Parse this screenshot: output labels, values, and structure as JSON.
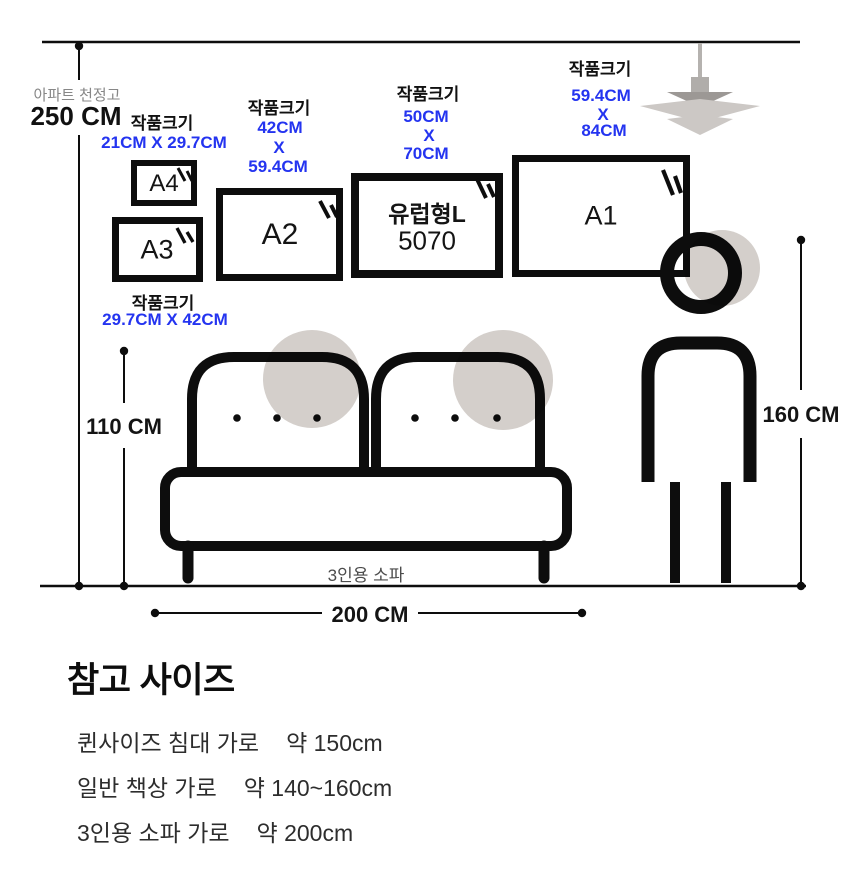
{
  "ceiling": {
    "label": "아파트 천정고",
    "value": "250 CM"
  },
  "frames": [
    {
      "name": "A4",
      "size_caption": "작품크기",
      "size": "21CM X 29.7CM"
    },
    {
      "name": "A3",
      "size_caption": "작품크기",
      "size": "29.7CM X 42CM"
    },
    {
      "name": "A2",
      "size_caption": "작품크기",
      "size_lines": [
        "42CM",
        "X",
        "59.4CM"
      ]
    },
    {
      "name": "유럽형L",
      "subname": "5070",
      "size_caption": "작품크기",
      "size_lines": [
        "50CM",
        "X",
        "70CM"
      ]
    },
    {
      "name": "A1",
      "size_caption": "작품크기",
      "size_lines": [
        "59.4CM",
        "X",
        "84CM"
      ]
    }
  ],
  "dims": {
    "sofa_height": "110 CM",
    "person_height": "160 CM",
    "sofa_width": "200 CM"
  },
  "sofa": {
    "caption": "3인용 소파"
  },
  "reference": {
    "title": "참고 사이즈",
    "items": [
      {
        "label": "퀸사이즈 침대 가로",
        "value": "약 150cm"
      },
      {
        "label": "일반 책상 가로",
        "value": "약 140~160cm"
      },
      {
        "label": "3인용 소파 가로",
        "value": "약 200cm"
      }
    ]
  },
  "colors": {
    "accent_blue": "#2434f0",
    "circle_beige": "#d4cfcb",
    "ink": "#0d0d0d",
    "lamp_gray": "#ccc8c5"
  }
}
